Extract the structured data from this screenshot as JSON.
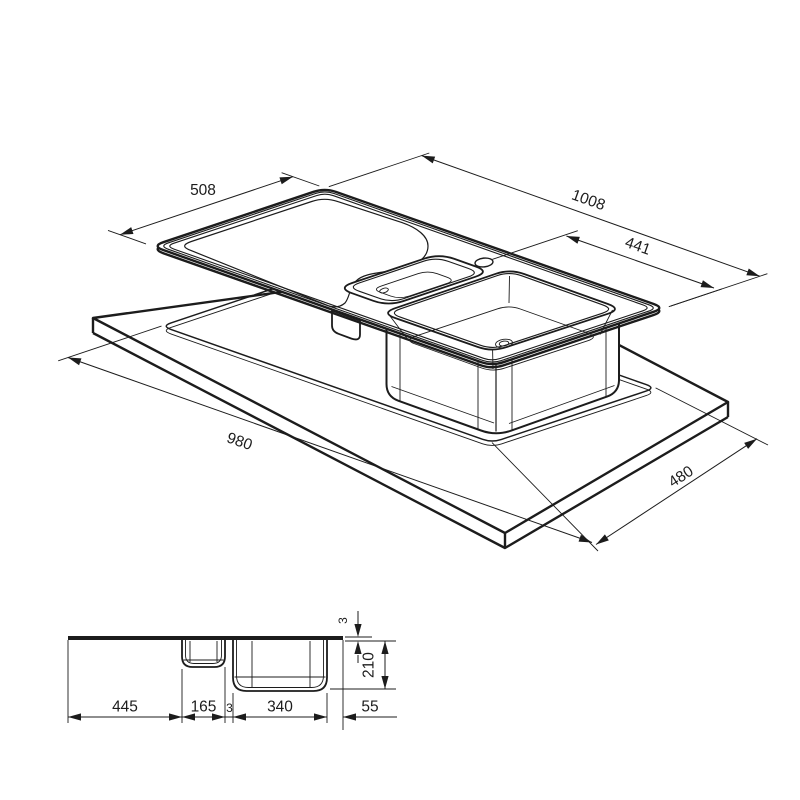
{
  "page": {
    "background": "#ffffff",
    "line_color": "#1c1c1c",
    "drawing_type": "technical dimension drawing",
    "subject": "inset kitchen sink with drainer, 1.5 bowls, and worktop cutout"
  },
  "isometric_view": {
    "description": "exploded isometric view of sink top above worktop cutout",
    "dimensions": {
      "sink_width": "508",
      "sink_length": "1008",
      "tap_hole_offset": "441",
      "cutout_length": "980",
      "cutout_width": "480"
    }
  },
  "section_view": {
    "description": "front elevation of sink profile",
    "dimensions": {
      "drainer_length": "445",
      "small_bowl_width": "165",
      "divider_width": "3",
      "main_bowl_width": "340",
      "right_margin": "55",
      "rim_thickness": "3",
      "bowl_depth": "210"
    }
  }
}
